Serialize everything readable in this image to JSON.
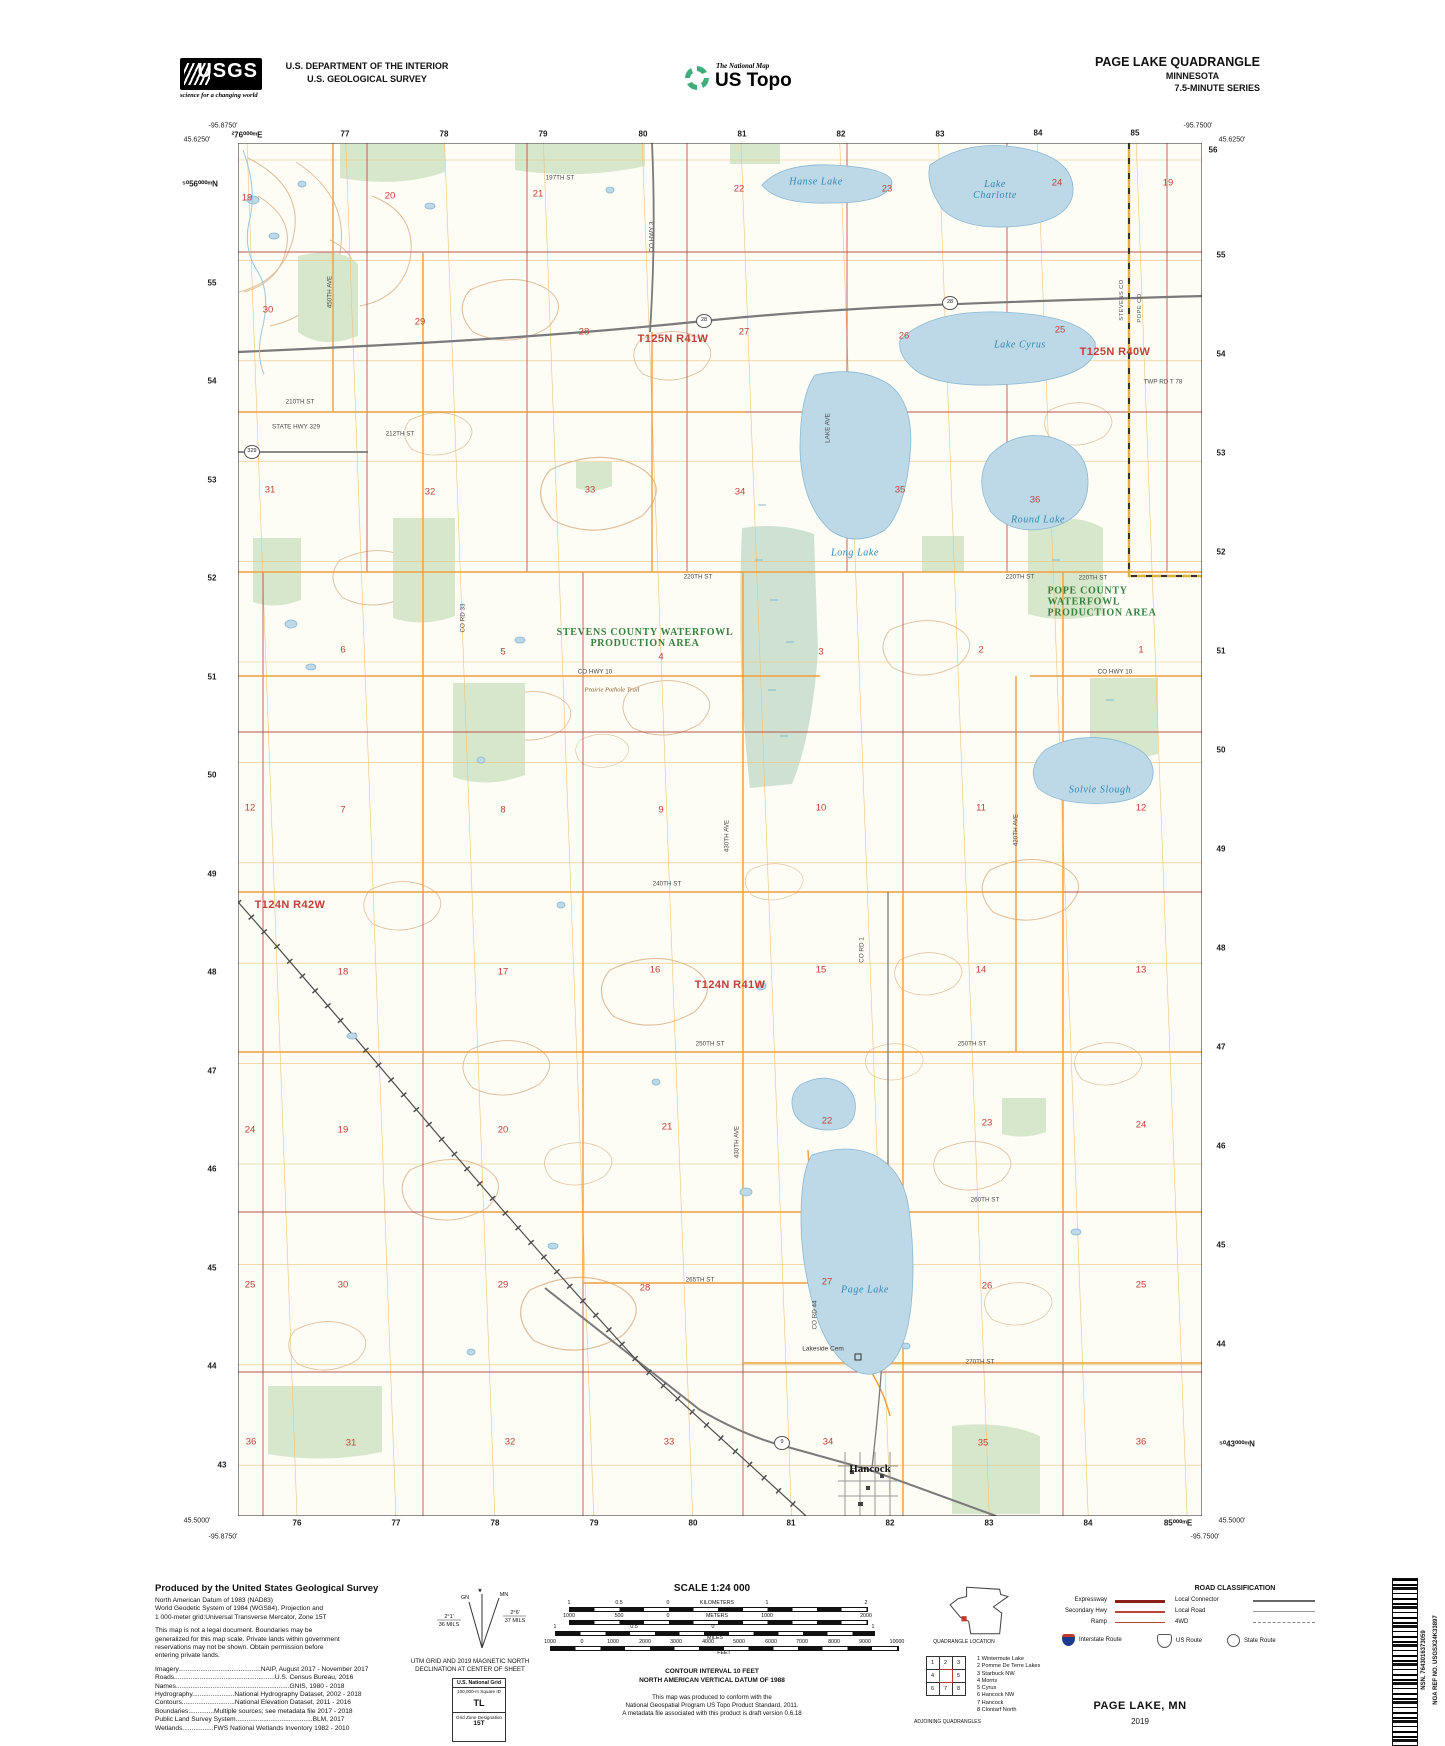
{
  "header": {
    "usgs_logo": "USGS",
    "usgs_tagline": "science for a changing world",
    "dept_line1": "U.S. DEPARTMENT OF THE INTERIOR",
    "dept_line2": "U.S. GEOLOGICAL SURVEY",
    "ustopo_small": "The National Map",
    "ustopo_big": "US Topo",
    "quad_title": "PAGE LAKE QUADRANGLE",
    "quad_state": "MINNESOTA",
    "quad_series": "7.5-MINUTE SERIES"
  },
  "map": {
    "labels": [
      [
        "-95.8750'",
        223,
        126,
        "corner"
      ],
      [
        "45.6250'",
        197,
        140,
        "corner"
      ],
      [
        "²76⁰⁰⁰ᵐE",
        247,
        135,
        "grid"
      ],
      [
        "77",
        345,
        134,
        "grid"
      ],
      [
        "78",
        444,
        134,
        "grid"
      ],
      [
        "79",
        543,
        134,
        "grid"
      ],
      [
        "80",
        643,
        134,
        "grid"
      ],
      [
        "81",
        742,
        134,
        "grid"
      ],
      [
        "82",
        841,
        134,
        "grid"
      ],
      [
        "83",
        940,
        134,
        "grid"
      ],
      [
        "84",
        1038,
        133,
        "grid"
      ],
      [
        "85",
        1135,
        133,
        "grid"
      ],
      [
        "-95.7500'",
        1198,
        126,
        "corner"
      ],
      [
        "45.6250'",
        1232,
        140,
        "corner"
      ],
      [
        "⁵⁰56⁰⁰⁰ᵐN",
        200,
        184,
        "grid"
      ],
      [
        "55",
        212,
        283,
        "grid"
      ],
      [
        "54",
        212,
        381,
        "grid"
      ],
      [
        "53",
        212,
        480,
        "grid"
      ],
      [
        "52",
        212,
        578,
        "grid"
      ],
      [
        "51",
        212,
        677,
        "grid"
      ],
      [
        "50",
        212,
        775,
        "grid"
      ],
      [
        "49",
        212,
        874,
        "grid"
      ],
      [
        "48",
        212,
        972,
        "grid"
      ],
      [
        "47",
        212,
        1071,
        "grid"
      ],
      [
        "46",
        212,
        1169,
        "grid"
      ],
      [
        "45",
        212,
        1268,
        "grid"
      ],
      [
        "44",
        212,
        1366,
        "grid"
      ],
      [
        "43",
        222,
        1465,
        "grid"
      ],
      [
        "56",
        1213,
        150,
        "grid"
      ],
      [
        "55",
        1221,
        255,
        "grid"
      ],
      [
        "54",
        1221,
        354,
        "grid"
      ],
      [
        "53",
        1221,
        453,
        "grid"
      ],
      [
        "52",
        1221,
        552,
        "grid"
      ],
      [
        "51",
        1221,
        651,
        "grid"
      ],
      [
        "50",
        1221,
        750,
        "grid"
      ],
      [
        "49",
        1221,
        849,
        "grid"
      ],
      [
        "48",
        1221,
        948,
        "grid"
      ],
      [
        "47",
        1221,
        1047,
        "grid"
      ],
      [
        "46",
        1221,
        1146,
        "grid"
      ],
      [
        "45",
        1221,
        1245,
        "grid"
      ],
      [
        "44",
        1221,
        1344,
        "grid"
      ],
      [
        "⁵⁰43⁰⁰⁰ᵐN",
        1237,
        1444,
        "grid"
      ],
      [
        "45.5000'",
        197,
        1521,
        "corner"
      ],
      [
        "-95.8750'",
        223,
        1537,
        "corner"
      ],
      [
        "76",
        297,
        1523,
        "grid"
      ],
      [
        "77",
        396,
        1523,
        "grid"
      ],
      [
        "78",
        495,
        1523,
        "grid"
      ],
      [
        "79",
        594,
        1523,
        "grid"
      ],
      [
        "80",
        693,
        1523,
        "grid"
      ],
      [
        "81",
        791,
        1523,
        "grid"
      ],
      [
        "82",
        890,
        1523,
        "grid"
      ],
      [
        "83",
        989,
        1523,
        "grid"
      ],
      [
        "84",
        1088,
        1523,
        "grid"
      ],
      [
        "85⁰⁰⁰ᵐE",
        1178,
        1523,
        "grid"
      ],
      [
        "45.5000'",
        1232,
        1521,
        "corner"
      ],
      [
        "-95.7500'",
        1205,
        1537,
        "corner"
      ],
      [
        "T125N R41W",
        673,
        339,
        "twp"
      ],
      [
        "T125N R40W",
        1115,
        352,
        "twp"
      ],
      [
        "T124N R42W",
        290,
        905,
        "twp"
      ],
      [
        "T124N R41W",
        730,
        985,
        "twp"
      ],
      [
        "STEVENS COUNTY WATERFOWL\nPRODUCTION AREA",
        645,
        638,
        "area"
      ],
      [
        "POPE COUNTY\nWATERFOWL\nPRODUCTION AREA",
        1102,
        602,
        "areal"
      ],
      [
        "Hanse Lake",
        816,
        182,
        "lake"
      ],
      [
        "Lake\nCharlotte",
        995,
        190,
        "lake"
      ],
      [
        "Lake Cyrus",
        1020,
        345,
        "lake"
      ],
      [
        "Long Lake",
        855,
        553,
        "lake"
      ],
      [
        "Round Lake",
        1038,
        520,
        "lake"
      ],
      [
        "Solvie Slough",
        1100,
        790,
        "lake"
      ],
      [
        "Page Lake",
        865,
        1290,
        "lake"
      ],
      [
        "Hancock",
        870,
        1469,
        "place"
      ],
      [
        "Lakeside Cem",
        823,
        1349,
        "cem"
      ],
      [
        "19",
        247,
        198,
        "sec"
      ],
      [
        "20",
        390,
        196,
        "sec"
      ],
      [
        "21",
        538,
        194,
        "sec"
      ],
      [
        "22",
        739,
        189,
        "sec"
      ],
      [
        "23",
        887,
        189,
        "sec"
      ],
      [
        "24",
        1057,
        183,
        "sec"
      ],
      [
        "19",
        1168,
        183,
        "sec"
      ],
      [
        "30",
        268,
        310,
        "sec"
      ],
      [
        "29",
        420,
        322,
        "sec"
      ],
      [
        "28",
        584,
        332,
        "sec"
      ],
      [
        "27",
        744,
        332,
        "sec"
      ],
      [
        "26",
        904,
        336,
        "sec"
      ],
      [
        "25",
        1060,
        330,
        "sec"
      ],
      [
        "31",
        270,
        490,
        "sec"
      ],
      [
        "32",
        430,
        492,
        "sec"
      ],
      [
        "33",
        590,
        490,
        "sec"
      ],
      [
        "34",
        740,
        492,
        "sec"
      ],
      [
        "35",
        900,
        490,
        "sec"
      ],
      [
        "36",
        1035,
        500,
        "sec"
      ],
      [
        "6",
        343,
        650,
        "sec"
      ],
      [
        "5",
        503,
        652,
        "sec"
      ],
      [
        "4",
        661,
        657,
        "sec"
      ],
      [
        "3",
        821,
        652,
        "sec"
      ],
      [
        "2",
        981,
        650,
        "sec"
      ],
      [
        "1",
        1141,
        650,
        "sec"
      ],
      [
        "12",
        250,
        808,
        "sec"
      ],
      [
        "7",
        343,
        810,
        "sec"
      ],
      [
        "8",
        503,
        810,
        "sec"
      ],
      [
        "9",
        661,
        810,
        "sec"
      ],
      [
        "10",
        821,
        808,
        "sec"
      ],
      [
        "11",
        981,
        808,
        "sec"
      ],
      [
        "12",
        1141,
        808,
        "sec"
      ],
      [
        "18",
        343,
        972,
        "sec"
      ],
      [
        "17",
        503,
        972,
        "sec"
      ],
      [
        "16",
        655,
        970,
        "sec"
      ],
      [
        "15",
        821,
        970,
        "sec"
      ],
      [
        "14",
        981,
        970,
        "sec"
      ],
      [
        "13",
        1141,
        970,
        "sec"
      ],
      [
        "24",
        250,
        1130,
        "sec"
      ],
      [
        "19",
        343,
        1130,
        "sec"
      ],
      [
        "20",
        503,
        1130,
        "sec"
      ],
      [
        "21",
        667,
        1127,
        "sec"
      ],
      [
        "22",
        827,
        1121,
        "sec"
      ],
      [
        "23",
        987,
        1123,
        "sec"
      ],
      [
        "24",
        1141,
        1125,
        "sec"
      ],
      [
        "25",
        250,
        1285,
        "sec"
      ],
      [
        "30",
        343,
        1285,
        "sec"
      ],
      [
        "29",
        503,
        1285,
        "sec"
      ],
      [
        "28",
        645,
        1288,
        "sec"
      ],
      [
        "27",
        827,
        1282,
        "sec"
      ],
      [
        "26",
        987,
        1286,
        "sec"
      ],
      [
        "25",
        1141,
        1285,
        "sec"
      ],
      [
        "36",
        251,
        1442,
        "sec"
      ],
      [
        "31",
        351,
        1443,
        "sec"
      ],
      [
        "32",
        510,
        1442,
        "sec"
      ],
      [
        "33",
        669,
        1442,
        "sec"
      ],
      [
        "34",
        828,
        1442,
        "sec"
      ],
      [
        "35",
        983,
        1443,
        "sec"
      ],
      [
        "36",
        1141,
        1442,
        "sec"
      ],
      [
        "197TH ST",
        560,
        178,
        "road"
      ],
      [
        "210TH ST",
        300,
        402,
        "road"
      ],
      [
        "STATE HWY 329",
        296,
        427,
        "road"
      ],
      [
        "212TH ST",
        400,
        434,
        "road"
      ],
      [
        "220TH ST",
        698,
        577,
        "road"
      ],
      [
        "220TH ST",
        1020,
        577,
        "road"
      ],
      [
        "220TH ST",
        1093,
        578,
        "road"
      ],
      [
        "CO HWY 10",
        595,
        672,
        "road"
      ],
      [
        "CO HWY 10",
        1115,
        672,
        "road"
      ],
      [
        "Prairie Pothole Trail",
        612,
        690,
        "trail"
      ],
      [
        "240TH ST",
        667,
        884,
        "road"
      ],
      [
        "250TH ST",
        710,
        1044,
        "road"
      ],
      [
        "250TH ST",
        972,
        1044,
        "road"
      ],
      [
        "260TH ST",
        985,
        1200,
        "road"
      ],
      [
        "265TH ST",
        700,
        1280,
        "road"
      ],
      [
        "270TH ST",
        980,
        1362,
        "road"
      ],
      [
        "TWP RD T 78",
        1163,
        382,
        "road"
      ],
      [
        "450TH AVE",
        330,
        292,
        "roadv"
      ],
      [
        "CO RD 33",
        463,
        618,
        "roadv"
      ],
      [
        "CO HWY 3",
        652,
        237,
        "roadv"
      ],
      [
        "LAKE AVE",
        828,
        428,
        "roadv"
      ],
      [
        "430TH AVE",
        727,
        836,
        "roadv"
      ],
      [
        "420TH AVE",
        1016,
        830,
        "roadv"
      ],
      [
        "CO RD 1",
        862,
        950,
        "roadv"
      ],
      [
        "430TH AVE",
        737,
        1142,
        "roadv"
      ],
      [
        "CO RD 44",
        815,
        1315,
        "roadv"
      ],
      [
        "STEVENS CO",
        1122,
        300,
        "cnty"
      ],
      [
        "POPE CO",
        1140,
        308,
        "cnty"
      ],
      [
        "28",
        704,
        321,
        "shield"
      ],
      [
        "28",
        950,
        303,
        "shield"
      ],
      [
        "9",
        782,
        1443,
        "shield"
      ],
      [
        "329",
        252,
        452,
        "shield"
      ]
    ]
  },
  "footer": {
    "produced": {
      "title": "Produced by the United States Geological Survey",
      "datum_lines": [
        "North American Datum of 1983 (NAD83)",
        "World Geodetic System of 1984 (WGS84).  Projection and",
        "1 000-meter grid:Universal Transverse Mercator, Zone 15T"
      ],
      "legal_lines": [
        "This map is not a legal document. Boundaries may be",
        "generalized for this map scale. Private lands within government",
        "reservations may not be shown. Obtain permission before",
        "entering private lands."
      ],
      "credits": [
        "Imagery.............................................NAIP, August 2017 - November 2017",
        "Roads.......................................................U.S. Census Bureau, 2016",
        "Names..............................................................GNIS, 1980 - 2018",
        "Hydrography.......................National Hydrography Dataset, 2002 - 2018",
        "Contours.............................National Elevation Dataset, 2011 - 2016",
        "Boundaries..............Multiple sources; see metadata file 2017 - 2018",
        "Public Land Survey System..........................................BLM, 2017",
        "Wetlands.................FWS National Wetlands Inventory 1982 - 2010"
      ]
    },
    "declination": {
      "star": "★",
      "gn": "GN",
      "mn": "MN",
      "gn_deg": "2°1'",
      "gn_mils": "36 MILS",
      "mn_deg": "2°6'",
      "mn_mils": "37 MILS",
      "caption1": "UTM GRID AND 2019 MAGNETIC NORTH",
      "caption2": "DECLINATION AT CENTER OF SHEET"
    },
    "usng": {
      "title": "U.S. National Grid",
      "square_label": "100,000-m Square ID",
      "square": "TL",
      "zone_label": "Grid Zone Designation",
      "zone": "15T"
    },
    "scale": {
      "title": "SCALE 1:24 000",
      "bars": [
        {
          "x": 569,
          "y": 1607,
          "w": 297,
          "labels": [
            [
              "1",
              0
            ],
            [
              "0.5",
              50
            ],
            [
              "0",
              99
            ],
            [
              "KILOMETERS",
              148
            ],
            [
              "1",
              198
            ],
            [
              "2",
              297
            ]
          ]
        },
        {
          "x": 569,
          "y": 1620,
          "w": 297,
          "labels": [
            [
              "1000",
              0
            ],
            [
              "500",
              50
            ],
            [
              "0",
              99
            ],
            [
              "METERS",
              148
            ],
            [
              "1000",
              198
            ],
            [
              "2000",
              297
            ]
          ]
        },
        {
          "x": 555,
          "y": 1631,
          "w": 318,
          "labels": [
            [
              "1",
              0
            ],
            [
              "0.5",
              79
            ],
            [
              "0",
              158
            ],
            [
              "1",
              318
            ]
          ],
          "unit": [
            "MILES",
            160
          ]
        },
        {
          "x": 550,
          "y": 1646,
          "w": 347,
          "labels": [
            [
              "1000",
              0
            ],
            [
              "0",
              32
            ],
            [
              "1000",
              63
            ],
            [
              "2000",
              95
            ],
            [
              "3000",
              126
            ],
            [
              "4000",
              158
            ],
            [
              "5000",
              189
            ],
            [
              "6000",
              221
            ],
            [
              "7000",
              252
            ],
            [
              "8000",
              284
            ],
            [
              "9000",
              315
            ],
            [
              "10000",
              347
            ]
          ],
          "unit": [
            "FEET",
            174
          ]
        }
      ],
      "contour": "CONTOUR INTERVAL 10 FEET",
      "vdatum": "NORTH AMERICAN VERTICAL DATUM OF 1988",
      "conform_lines": [
        "This map was produced to conform with the",
        "National Geospatial Program US Topo Product Standard, 2011.",
        "A metadata file associated with this product is draft version 0.6.18"
      ]
    },
    "quad_location_caption": "QUADRANGLE LOCATION",
    "adjoining": {
      "cells": [
        "1",
        "2",
        "3",
        "4",
        "",
        "5",
        "6",
        "7",
        "8"
      ],
      "names": [
        "1 Wintermute Lake",
        "2 Pomme De Terre Lakes",
        "3 Starbuck NW",
        "4 Morris",
        "5 Cyrus",
        "6 Hancock NW",
        "7 Hancock",
        "8 Clontarf North"
      ],
      "caption": "ADJOINING QUADRANGLES"
    },
    "road_class": {
      "title": "ROAD CLASSIFICATION",
      "col1": [
        [
          "Expressway",
          "expressway"
        ],
        [
          "Secondary Hwy",
          "secondary"
        ],
        [
          "Ramp",
          "ramp"
        ]
      ],
      "col2": [
        [
          "Local Connector",
          "connector"
        ],
        [
          "Local Road",
          "local"
        ],
        [
          "4WD",
          "fourwd"
        ]
      ],
      "shields": [
        [
          "interstate",
          "Interstate Route",
          0
        ],
        [
          "us",
          "US Route",
          95
        ],
        [
          "state",
          "State Route",
          165
        ]
      ]
    },
    "map_name": "PAGE LAKE,  MN",
    "year": "2019",
    "barcode": {
      "nsn": "NSN. 7643016373059",
      "nga": "NGA REF NO. USGSX24K33897"
    }
  }
}
